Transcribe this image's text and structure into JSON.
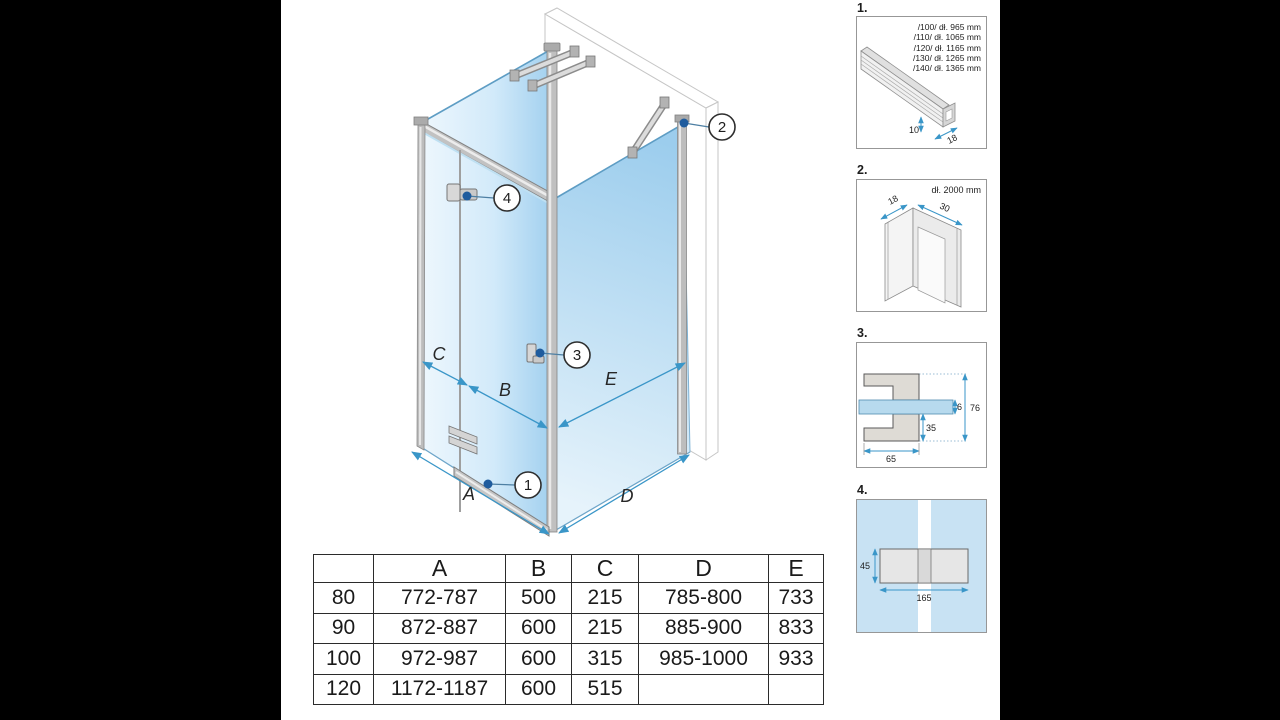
{
  "main": {
    "dims": {
      "a": "A",
      "b": "B",
      "c": "C",
      "d": "D",
      "e": "E"
    },
    "callouts": {
      "c1": "1",
      "c2": "2",
      "c3": "3",
      "c4": "4"
    }
  },
  "details": {
    "d1": {
      "label": "1.",
      "lines": [
        "/100/ dł. 965 mm",
        "/110/ dł. 1065 mm",
        "/120/ dł. 1165 mm",
        "/130/ dł. 1265 mm",
        "/140/ dł. 1365 mm"
      ],
      "dim_height": "10",
      "dim_depth": "18"
    },
    "d2": {
      "label": "2.",
      "length": "dł. 2000 mm",
      "dim_a": "18",
      "dim_b": "30"
    },
    "d3": {
      "label": "3.",
      "dim_glass": "6",
      "dim_total": "76",
      "dim_lower": "35",
      "dim_width": "65"
    },
    "d4": {
      "label": "4.",
      "dim_height": "45",
      "dim_width": "165"
    }
  },
  "table": {
    "headers": [
      "",
      "A",
      "B",
      "C",
      "D",
      "E"
    ],
    "col_widths": [
      59,
      131,
      65,
      66,
      129,
      54
    ],
    "rows": [
      [
        "80",
        "772-787",
        "500",
        "215",
        "785-800",
        "733"
      ],
      [
        "90",
        "872-887",
        "600",
        "215",
        "885-900",
        "833"
      ],
      [
        "100",
        "972-987",
        "600",
        "315",
        "985-1000",
        "933"
      ],
      [
        "120",
        "1172-1187",
        "600",
        "515",
        "",
        ""
      ]
    ]
  },
  "colors": {
    "dimension_blue": "#3a96c8",
    "callout_dot": "#1f5c9e",
    "glass_light": "#edf6fc",
    "glass_dark": "#a5d2ee"
  }
}
